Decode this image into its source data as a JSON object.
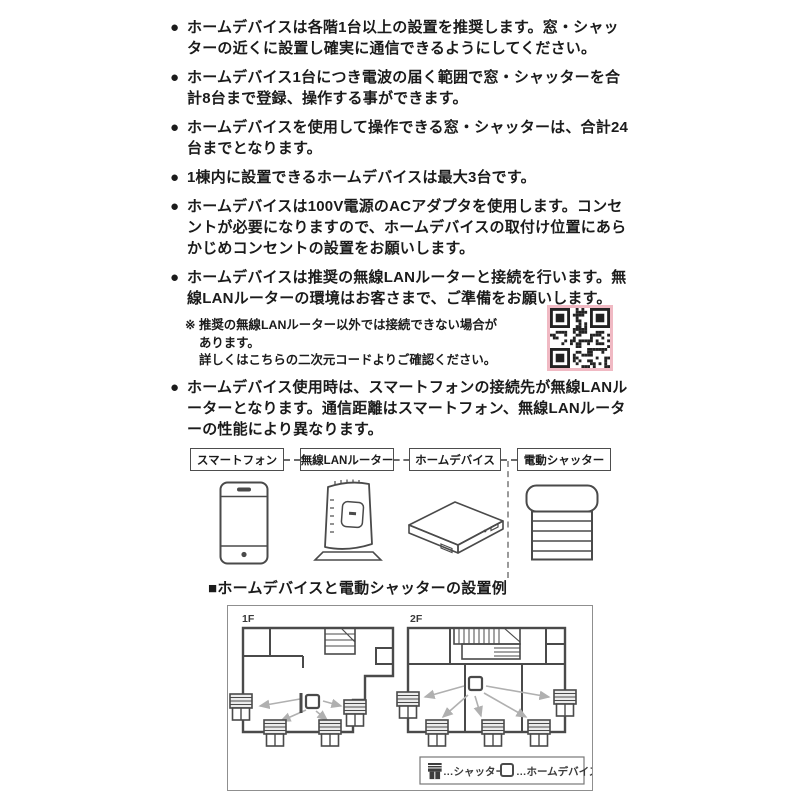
{
  "ui": {
    "bullet_marker": "●",
    "note_marker": "※"
  },
  "bullets": [
    "ホームデバイスは各階1台以上の設置を推奨します。窓・シャッターの近くに設置し確実に通信できるようにしてください。",
    "ホームデバイス1台につき電波の届く範囲で窓・シャッターを合計8台まで登録、操作する事ができます。",
    "ホームデバイスを使用して操作できる窓・シャッターは、合計24台までとなります。",
    "1棟内に設置できるホームデバイスは最大3台です。",
    "ホームデバイスは100V電源のACアダプタを使用します。コンセントが必要になりますので、ホームデバイスの取付け位置にあらかじめコンセントの設置をお願いします。",
    "ホームデバイスは推奨の無線LANルーターと接続を行います。無線LANルーターの環境はお客さまで、ご準備をお願いします。",
    "ホームデバイス使用時は、スマートフォンの接続先が無線LANルーターとなります。通信距離はスマートフォン、無線LANルーターの性能により異なります。"
  ],
  "note": {
    "line1": "推奨の無線LANルーター以外では接続できない場合があります。",
    "line2": "詳しくはこちらの二次元コードよりご確認ください。"
  },
  "chain": {
    "nodes": [
      {
        "label": "スマートフォン"
      },
      {
        "label": "無線LANルーター"
      },
      {
        "label": "ホームデバイス"
      },
      {
        "label": "電動シャッター"
      }
    ]
  },
  "section": {
    "title": "■ホームデバイスと電動シャッターの設置例"
  },
  "floorplan": {
    "floor1": "1F",
    "floor2": "2F",
    "legend": {
      "shutter": "…シャッター",
      "home_device": "…ホームデバイス"
    }
  },
  "colors": {
    "qr_border_pink": "#f0b9c3",
    "wall": "#4a4a4a",
    "arrow": "#b0b0b0"
  }
}
